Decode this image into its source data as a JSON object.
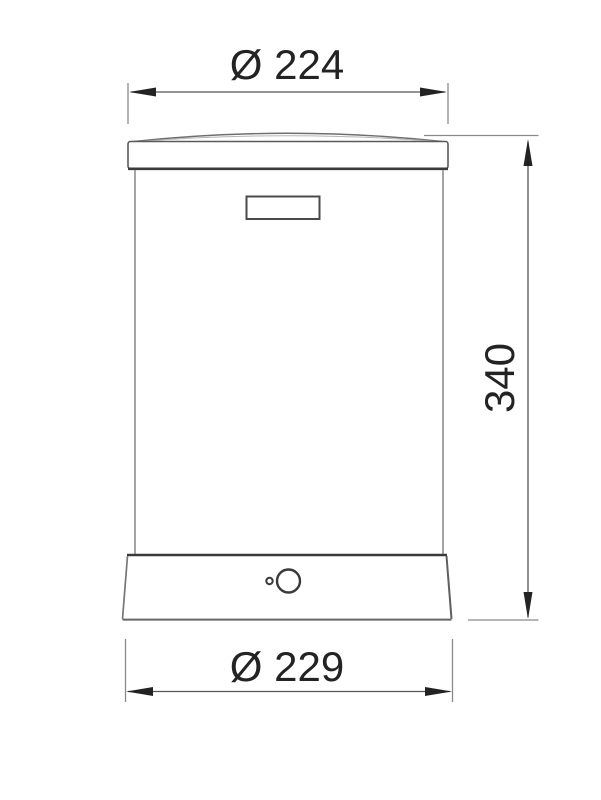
{
  "drawing": {
    "dimensions": {
      "top_diameter": {
        "label": "Ø 224"
      },
      "height": {
        "label": "340"
      },
      "bottom_diameter": {
        "label": "Ø 229"
      }
    },
    "colors": {
      "background": "#ffffff",
      "outline_dark": "#3a3a3a",
      "outline_mid": "#6e6e6e",
      "outline_light": "#9a9a9a",
      "dimension_line": "#555555",
      "extension_line": "#8a8a8a",
      "arrow_fill": "#232323",
      "text": "#232323"
    }
  }
}
